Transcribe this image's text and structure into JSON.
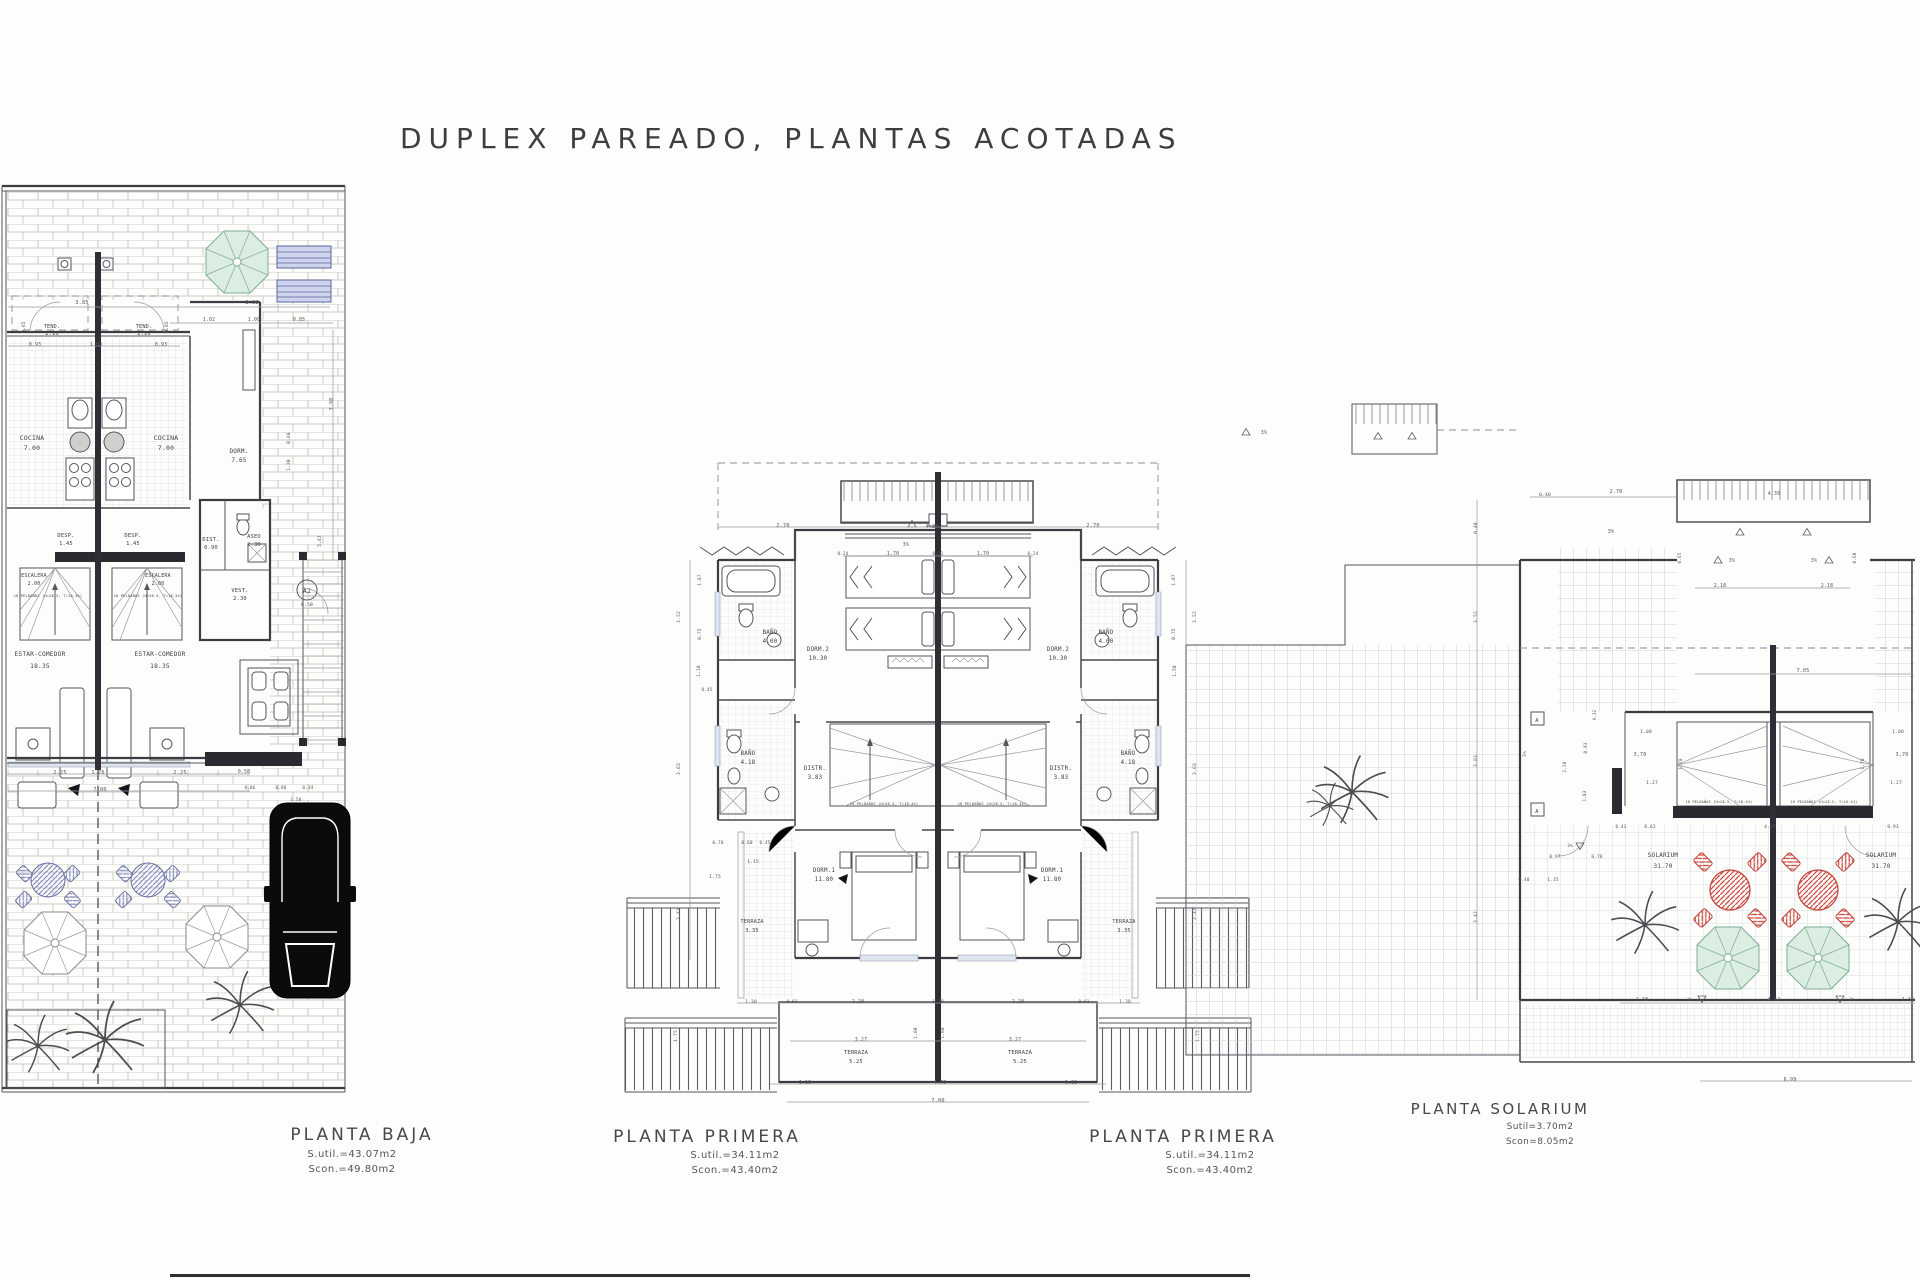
{
  "header": {
    "title": "DUPLEX PAREADO, PLANTAS ACOTADAS"
  },
  "colors": {
    "line": "#4a4a50",
    "dim": "#55555d",
    "teal_umbrella": "#dcede1",
    "blue_furniture": "#8790c5",
    "red_furniture": "#cf4a42",
    "car_black": "#0b0b0d",
    "grid_blue": "#bcc5dc",
    "brick_gray": "#ccccc6"
  },
  "planta_baja": {
    "name": "PLANTA BAJA",
    "sutil": "S.util.=43.07m2",
    "scon": "Scon.=49.80m2",
    "rooms": [
      {
        "t": "TEND.",
        "x": 52,
        "y": 328,
        "s": 5.2
      },
      {
        "t": "2.10",
        "x": 52,
        "y": 335,
        "s": 5.2
      },
      {
        "t": "TEND.",
        "x": 144,
        "y": 328,
        "s": 5.2
      },
      {
        "t": "2.10",
        "x": 144,
        "y": 335,
        "s": 5.2
      },
      {
        "t": "COCINA",
        "x": 32,
        "y": 440,
        "s": 6.5
      },
      {
        "t": "7.00",
        "x": 32,
        "y": 450,
        "s": 6.5
      },
      {
        "t": "COCINA",
        "x": 166,
        "y": 440,
        "s": 6.5
      },
      {
        "t": "7.00",
        "x": 166,
        "y": 450,
        "s": 6.5
      },
      {
        "t": "DORM.",
        "x": 239,
        "y": 453,
        "s": 6
      },
      {
        "t": "7.65",
        "x": 239,
        "y": 462,
        "s": 6
      },
      {
        "t": "DESP.",
        "x": 66,
        "y": 537,
        "s": 5.4
      },
      {
        "t": "1.45",
        "x": 66,
        "y": 545,
        "s": 5.4
      },
      {
        "t": "DESP.",
        "x": 133,
        "y": 537,
        "s": 5.4
      },
      {
        "t": "1.45",
        "x": 133,
        "y": 545,
        "s": 5.4
      },
      {
        "t": "DIST.",
        "x": 211,
        "y": 541,
        "s": 5.4
      },
      {
        "t": "0.90",
        "x": 211,
        "y": 549,
        "s": 5.4
      },
      {
        "t": "ASEO",
        "x": 254,
        "y": 538,
        "s": 5.4
      },
      {
        "t": "2.30",
        "x": 254,
        "y": 546,
        "s": 5.4
      },
      {
        "t": "ESCALERA",
        "x": 34,
        "y": 577,
        "s": 5
      },
      {
        "t": "2.00",
        "x": 34,
        "y": 585,
        "s": 5
      },
      {
        "t": "ESCALERA",
        "x": 158,
        "y": 577,
        "s": 5
      },
      {
        "t": "2.00",
        "x": 158,
        "y": 585,
        "s": 5
      },
      {
        "t": "16 PELDAÑOS (H=28.5, T=18.44)",
        "x": 48,
        "y": 597,
        "s": 3.6
      },
      {
        "t": "16 PELDAÑOS (H=28.5, T=18.44)",
        "x": 148,
        "y": 597,
        "s": 3.6
      },
      {
        "t": "VEST.",
        "x": 240,
        "y": 592,
        "s": 5.4
      },
      {
        "t": "2.30",
        "x": 240,
        "y": 600,
        "s": 5.4
      },
      {
        "t": "A2",
        "x": 307,
        "y": 593,
        "s": 6.5
      },
      {
        "t": "0.50",
        "x": 307,
        "y": 606,
        "s": 4.6
      },
      {
        "t": "ESTAR-COMEDOR",
        "x": 40,
        "y": 656,
        "s": 6.2
      },
      {
        "t": "18.35",
        "x": 40,
        "y": 668,
        "s": 6.2
      },
      {
        "t": "ESTAR-COMEDOR",
        "x": 160,
        "y": 656,
        "s": 6.2
      },
      {
        "t": "18.35",
        "x": 160,
        "y": 668,
        "s": 6.2
      }
    ],
    "dims": [
      {
        "t": "3.85",
        "x": 82,
        "y": 304,
        "s": 5.2
      },
      {
        "t": "2.88",
        "x": 252,
        "y": 304,
        "s": 5.2
      },
      {
        "t": "1.02",
        "x": 209,
        "y": 321,
        "s": 4.8
      },
      {
        "t": "1.00",
        "x": 254,
        "y": 321,
        "s": 4.8
      },
      {
        "t": "0.85",
        "x": 299,
        "y": 321,
        "s": 4.8
      },
      {
        "t": "0.65",
        "x": 25,
        "y": 327,
        "s": 4.4,
        "r": -90
      },
      {
        "t": "0.65",
        "x": 168,
        "y": 327,
        "s": 4.4,
        "r": -90
      },
      {
        "t": "0.93",
        "x": 35,
        "y": 346,
        "s": 4.8
      },
      {
        "t": "1.80",
        "x": 96,
        "y": 346,
        "s": 4.8
      },
      {
        "t": "0.93",
        "x": 161,
        "y": 346,
        "s": 4.8
      },
      {
        "t": "3.98",
        "x": 333,
        "y": 404,
        "s": 4.8,
        "r": -90
      },
      {
        "t": "0.68",
        "x": 290,
        "y": 438,
        "s": 4.4,
        "r": -90
      },
      {
        "t": "1.30",
        "x": 290,
        "y": 465,
        "s": 4.4,
        "r": -90
      },
      {
        "t": "5.43",
        "x": 321,
        "y": 541,
        "s": 4.4,
        "r": -90
      },
      {
        "t": "2.25",
        "x": 60,
        "y": 774,
        "s": 5.2
      },
      {
        "t": "1.26",
        "x": 98,
        "y": 774,
        "s": 5.2
      },
      {
        "t": "2.25",
        "x": 180,
        "y": 774,
        "s": 5.2
      },
      {
        "t": "0.58",
        "x": 244,
        "y": 773,
        "s": 4.8
      },
      {
        "t": "7.00",
        "x": 100,
        "y": 791,
        "s": 5.2
      },
      {
        "t": "0.86",
        "x": 250,
        "y": 789,
        "s": 4.2
      },
      {
        "t": "0.80",
        "x": 281,
        "y": 789,
        "s": 4.2
      },
      {
        "t": "0.34",
        "x": 308,
        "y": 789,
        "s": 4.2
      },
      {
        "t": "1.50",
        "x": 296,
        "y": 801,
        "s": 4.2
      }
    ]
  },
  "planta_primera": {
    "name": "PLANTA PRIMERA",
    "sutil": "S.util.=34.11m2",
    "scon": "Scon.=43.40m2",
    "rooms": [
      {
        "t": "BAÑO",
        "x": 770,
        "y": 634,
        "s": 5.8
      },
      {
        "t": "4.00",
        "x": 770,
        "y": 643,
        "s": 5.8
      },
      {
        "t": "BAÑO",
        "x": 1106,
        "y": 634,
        "s": 5.8
      },
      {
        "t": "4.00",
        "x": 1106,
        "y": 643,
        "s": 5.8
      },
      {
        "t": "DORM.2",
        "x": 818,
        "y": 651,
        "s": 5.8
      },
      {
        "t": "10.30",
        "x": 818,
        "y": 660,
        "s": 5.8
      },
      {
        "t": "DORM.2",
        "x": 1058,
        "y": 651,
        "s": 5.8
      },
      {
        "t": "10.30",
        "x": 1058,
        "y": 660,
        "s": 5.8
      },
      {
        "t": "BAÑO",
        "x": 748,
        "y": 755,
        "s": 5.8
      },
      {
        "t": "4.18",
        "x": 748,
        "y": 764,
        "s": 5.8
      },
      {
        "t": "BAÑO",
        "x": 1128,
        "y": 755,
        "s": 5.8
      },
      {
        "t": "4.18",
        "x": 1128,
        "y": 764,
        "s": 5.8
      },
      {
        "t": "DISTR.",
        "x": 815,
        "y": 770,
        "s": 5.8
      },
      {
        "t": "3.83",
        "x": 815,
        "y": 779,
        "s": 5.8
      },
      {
        "t": "DISTR.",
        "x": 1061,
        "y": 770,
        "s": 5.8
      },
      {
        "t": "3.83",
        "x": 1061,
        "y": 779,
        "s": 5.8
      },
      {
        "t": "DORM.1",
        "x": 824,
        "y": 872,
        "s": 5.8
      },
      {
        "t": "11.80",
        "x": 824,
        "y": 881,
        "s": 5.8
      },
      {
        "t": "DORM.1",
        "x": 1052,
        "y": 872,
        "s": 5.8
      },
      {
        "t": "11.80",
        "x": 1052,
        "y": 881,
        "s": 5.8
      },
      {
        "t": "TERRAZA",
        "x": 752,
        "y": 923,
        "s": 5.2
      },
      {
        "t": "3.35",
        "x": 752,
        "y": 932,
        "s": 5.2
      },
      {
        "t": "TERRAZA",
        "x": 1124,
        "y": 923,
        "s": 5.2
      },
      {
        "t": "3.35",
        "x": 1124,
        "y": 932,
        "s": 5.2
      },
      {
        "t": "TERRAZA",
        "x": 856,
        "y": 1054,
        "s": 5.4
      },
      {
        "t": "5.25",
        "x": 856,
        "y": 1063,
        "s": 5.4
      },
      {
        "t": "TERRAZA",
        "x": 1020,
        "y": 1054,
        "s": 5.4
      },
      {
        "t": "5.25",
        "x": 1020,
        "y": 1063,
        "s": 5.4
      },
      {
        "t": "16 PELDAÑOS (H=28.5, T=18.44)",
        "x": 884,
        "y": 805,
        "s": 3.6
      },
      {
        "t": "16 PELDAÑOS (H=28.5, T=18.44)",
        "x": 992,
        "y": 805,
        "s": 3.6
      }
    ],
    "dims": [
      {
        "t": "2.70",
        "x": 783,
        "y": 527,
        "s": 5.2
      },
      {
        "t": "4.20",
        "x": 932,
        "y": 528,
        "s": 5.2
      },
      {
        "t": "2.70",
        "x": 1093,
        "y": 527,
        "s": 5.2
      },
      {
        "t": "3%",
        "x": 906,
        "y": 546,
        "s": 5
      },
      {
        "t": "0.24",
        "x": 843,
        "y": 555,
        "s": 4.2
      },
      {
        "t": "1.70",
        "x": 893,
        "y": 555,
        "s": 4.8
      },
      {
        "t": "0.31",
        "x": 938,
        "y": 555,
        "s": 4.2
      },
      {
        "t": "1.70",
        "x": 983,
        "y": 555,
        "s": 4.8
      },
      {
        "t": "0.24",
        "x": 1033,
        "y": 555,
        "s": 4.2
      },
      {
        "t": "1.67",
        "x": 701,
        "y": 580,
        "s": 4.4,
        "r": -90
      },
      {
        "t": "3.52",
        "x": 680,
        "y": 617,
        "s": 4.6,
        "r": -90
      },
      {
        "t": "0.75",
        "x": 701,
        "y": 634,
        "s": 4.4,
        "r": -90
      },
      {
        "t": "1.10",
        "x": 700,
        "y": 671,
        "s": 4.4,
        "r": -90
      },
      {
        "t": "0.45",
        "x": 707,
        "y": 691,
        "s": 4.2
      },
      {
        "t": "3.63",
        "x": 680,
        "y": 769,
        "s": 4.6,
        "r": -90
      },
      {
        "t": "1.67",
        "x": 1175,
        "y": 580,
        "s": 4.4,
        "r": -90
      },
      {
        "t": "3.52",
        "x": 1196,
        "y": 617,
        "s": 4.6,
        "r": -90
      },
      {
        "t": "0.75",
        "x": 1175,
        "y": 634,
        "s": 4.4,
        "r": -90
      },
      {
        "t": "1.50",
        "x": 1176,
        "y": 671,
        "s": 4.4,
        "r": -90
      },
      {
        "t": "3.63",
        "x": 1196,
        "y": 769,
        "s": 4.6,
        "r": -90
      },
      {
        "t": "0.70",
        "x": 718,
        "y": 844,
        "s": 4.4
      },
      {
        "t": "0.60",
        "x": 747,
        "y": 844,
        "s": 4.4
      },
      {
        "t": "0.45",
        "x": 765,
        "y": 844,
        "s": 4.2
      },
      {
        "t": "1.15",
        "x": 753,
        "y": 863,
        "s": 4.6
      },
      {
        "t": "1.75",
        "x": 715,
        "y": 878,
        "s": 4.6
      },
      {
        "t": "3.42",
        "x": 680,
        "y": 914,
        "s": 4.6,
        "r": -90
      },
      {
        "t": "3.42",
        "x": 1196,
        "y": 914,
        "s": 4.6,
        "r": -90
      },
      {
        "t": "1.30",
        "x": 751,
        "y": 1003,
        "s": 4.6
      },
      {
        "t": "0.61",
        "x": 792,
        "y": 1003,
        "s": 4.2
      },
      {
        "t": "2.20",
        "x": 858,
        "y": 1003,
        "s": 4.8
      },
      {
        "t": "1.38",
        "x": 938,
        "y": 1003,
        "s": 4.6
      },
      {
        "t": "2.20",
        "x": 1018,
        "y": 1003,
        "s": 4.8
      },
      {
        "t": "0.61",
        "x": 1084,
        "y": 1003,
        "s": 4.2
      },
      {
        "t": "1.30",
        "x": 1125,
        "y": 1003,
        "s": 4.6
      },
      {
        "t": "3.27",
        "x": 861,
        "y": 1041,
        "s": 4.8
      },
      {
        "t": "3.27",
        "x": 1015,
        "y": 1041,
        "s": 4.8
      },
      {
        "t": "1.60",
        "x": 917,
        "y": 1033,
        "s": 4.4,
        "r": -90
      },
      {
        "t": "1.60",
        "x": 944,
        "y": 1033,
        "s": 4.4,
        "r": -90
      },
      {
        "t": "1.75",
        "x": 677,
        "y": 1036,
        "s": 4.6,
        "r": -90
      },
      {
        "t": "1.75",
        "x": 1199,
        "y": 1036,
        "s": 4.6,
        "r": -90
      },
      {
        "t": "1.13",
        "x": 805,
        "y": 1084,
        "s": 4.8
      },
      {
        "t": "4.73",
        "x": 940,
        "y": 1084,
        "s": 5
      },
      {
        "t": "1.13",
        "x": 1071,
        "y": 1084,
        "s": 4.8
      },
      {
        "t": "7.00",
        "x": 938,
        "y": 1102,
        "s": 5.2
      }
    ]
  },
  "planta_solarium": {
    "name": "PLANTA SOLARIUM",
    "sutil": "Sutil=3.70m2",
    "scon": "Scon=8.05m2",
    "rooms": [
      {
        "t": "SOLARIUM",
        "x": 1663,
        "y": 857,
        "s": 6
      },
      {
        "t": "31.70",
        "x": 1663,
        "y": 868,
        "s": 6
      },
      {
        "t": "SOLARIUM",
        "x": 1881,
        "y": 857,
        "s": 6
      },
      {
        "t": "31.70",
        "x": 1881,
        "y": 868,
        "s": 6
      },
      {
        "t": "A",
        "x": 1537,
        "y": 722,
        "s": 5.4
      },
      {
        "t": "A",
        "x": 1537,
        "y": 813,
        "s": 5.4
      },
      {
        "t": "16 PELDAÑOS (H=28.5, T=18.44)",
        "x": 1719,
        "y": 803,
        "s": 3.5
      },
      {
        "t": "16 PELDAÑOS (H=28.5, T=18.44)",
        "x": 1824,
        "y": 803,
        "s": 3.5
      }
    ],
    "dims": [
      {
        "t": "0.40",
        "x": 1545,
        "y": 496,
        "s": 4.6
      },
      {
        "t": "2.70",
        "x": 1616,
        "y": 493,
        "s": 5
      },
      {
        "t": "4.39",
        "x": 1774,
        "y": 495,
        "s": 4.8
      },
      {
        "t": "3%",
        "x": 1264,
        "y": 434,
        "s": 5
      },
      {
        "t": "3%",
        "x": 1611,
        "y": 533,
        "s": 5
      },
      {
        "t": "0.40",
        "x": 1477,
        "y": 528,
        "s": 4.4,
        "r": -90
      },
      {
        "t": "3.52",
        "x": 1477,
        "y": 617,
        "s": 4.6,
        "r": -90
      },
      {
        "t": "3%",
        "x": 1732,
        "y": 562,
        "s": 4.8
      },
      {
        "t": "3%",
        "x": 1814,
        "y": 562,
        "s": 4.8
      },
      {
        "t": "0.65",
        "x": 1681,
        "y": 558,
        "s": 4.2,
        "r": -90
      },
      {
        "t": "0.60",
        "x": 1856,
        "y": 558,
        "s": 4.2,
        "r": -90
      },
      {
        "t": "2.18",
        "x": 1720,
        "y": 587,
        "s": 4.8
      },
      {
        "t": "2.18",
        "x": 1827,
        "y": 587,
        "s": 4.8
      },
      {
        "t": "7.05",
        "x": 1803,
        "y": 672,
        "s": 5
      },
      {
        "t": "3%",
        "x": 1526,
        "y": 754,
        "s": 4.6,
        "r": -90
      },
      {
        "t": "3.03",
        "x": 1477,
        "y": 761,
        "s": 4.6,
        "r": -90
      },
      {
        "t": "0.32",
        "x": 1596,
        "y": 715,
        "s": 4,
        "r": -90
      },
      {
        "t": "2.28",
        "x": 1566,
        "y": 767,
        "s": 4.2,
        "r": -90
      },
      {
        "t": "0.93",
        "x": 1587,
        "y": 748,
        "s": 4.2,
        "r": -90
      },
      {
        "t": "1.03",
        "x": 1586,
        "y": 796,
        "s": 4.2,
        "r": -90
      },
      {
        "t": "1.00",
        "x": 1646,
        "y": 733,
        "s": 4.6
      },
      {
        "t": "1.00",
        "x": 1898,
        "y": 733,
        "s": 4.6
      },
      {
        "t": "3,70",
        "x": 1640,
        "y": 756,
        "s": 5
      },
      {
        "t": "3,70",
        "x": 1902,
        "y": 756,
        "s": 5
      },
      {
        "t": "1,78",
        "x": 1682,
        "y": 764,
        "s": 4.4,
        "r": -90
      },
      {
        "t": "1,78",
        "x": 1864,
        "y": 764,
        "s": 4.4,
        "r": -90
      },
      {
        "t": "1.27",
        "x": 1652,
        "y": 784,
        "s": 4.6
      },
      {
        "t": "1.27",
        "x": 1896,
        "y": 784,
        "s": 4.6
      },
      {
        "t": "0.43",
        "x": 1621,
        "y": 828,
        "s": 4.2
      },
      {
        "t": "0.63",
        "x": 1650,
        "y": 828,
        "s": 4.4
      },
      {
        "t": "4.39",
        "x": 1770,
        "y": 828,
        "s": 4.6
      },
      {
        "t": "0.93",
        "x": 1893,
        "y": 828,
        "s": 4.4
      },
      {
        "t": "0.97",
        "x": 1555,
        "y": 858,
        "s": 4.4
      },
      {
        "t": "0.78",
        "x": 1597,
        "y": 858,
        "s": 4.4
      },
      {
        "t": "3%",
        "x": 1570,
        "y": 847,
        "s": 4.2
      },
      {
        "t": "0.40",
        "x": 1524,
        "y": 881,
        "s": 4.4
      },
      {
        "t": "1.35",
        "x": 1553,
        "y": 881,
        "s": 4.4
      },
      {
        "t": "3.42",
        "x": 1477,
        "y": 917,
        "s": 4.6,
        "r": -90
      },
      {
        "t": "1.18",
        "x": 1642,
        "y": 1001,
        "s": 4.8
      },
      {
        "t": "3%",
        "x": 1690,
        "y": 1001,
        "s": 4.6
      },
      {
        "t": "4.64",
        "x": 1774,
        "y": 1001,
        "s": 5
      },
      {
        "t": "3%",
        "x": 1852,
        "y": 1001,
        "s": 4.6
      },
      {
        "t": "1.18",
        "x": 1908,
        "y": 1001,
        "s": 4.8
      },
      {
        "t": "6.99",
        "x": 1790,
        "y": 1081,
        "s": 5
      }
    ]
  }
}
